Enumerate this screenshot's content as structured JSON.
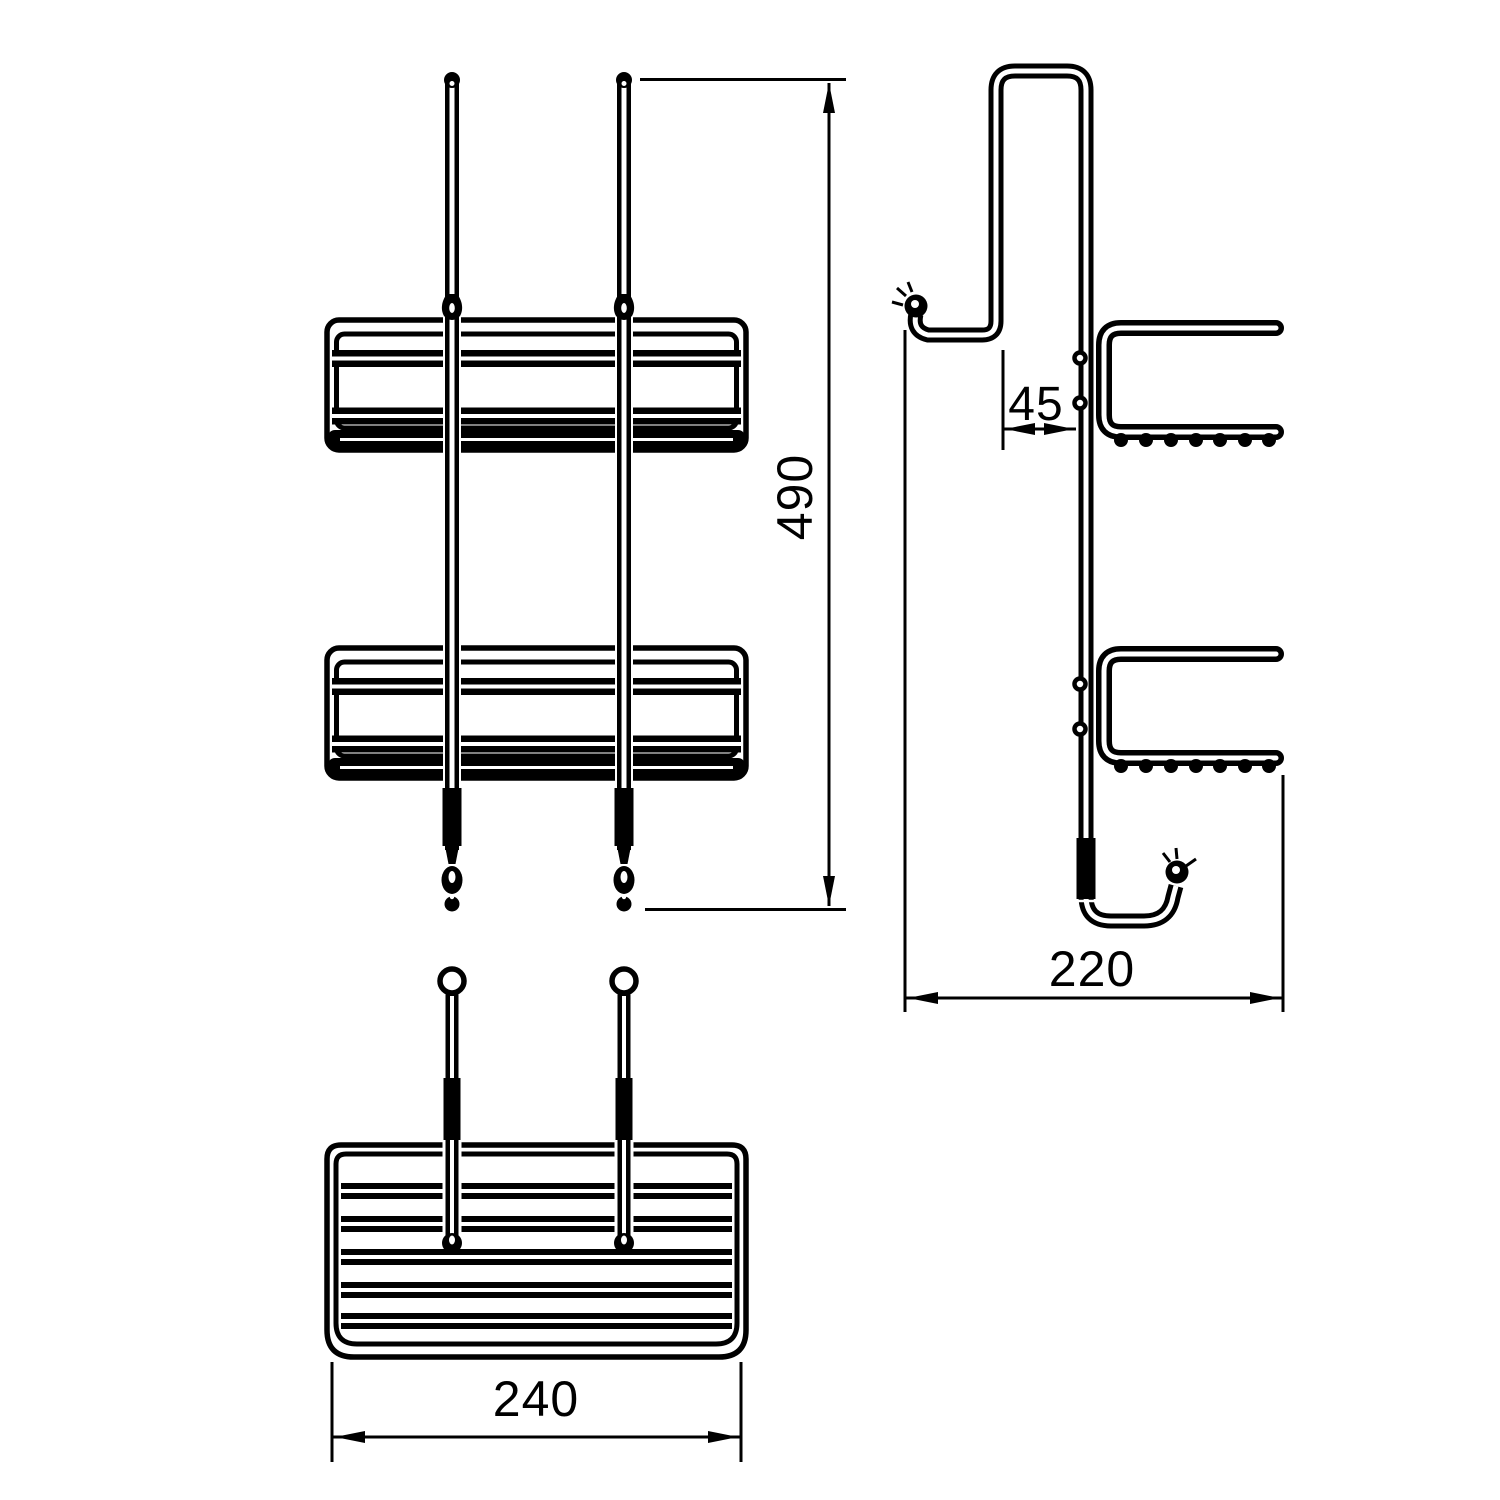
{
  "palette": {
    "line_color": "#000000",
    "background_color": "#ffffff"
  },
  "dimension_labels": {
    "overall_height": "490",
    "hook_opening": "45",
    "basket_width": "240",
    "overall_depth": "220"
  }
}
